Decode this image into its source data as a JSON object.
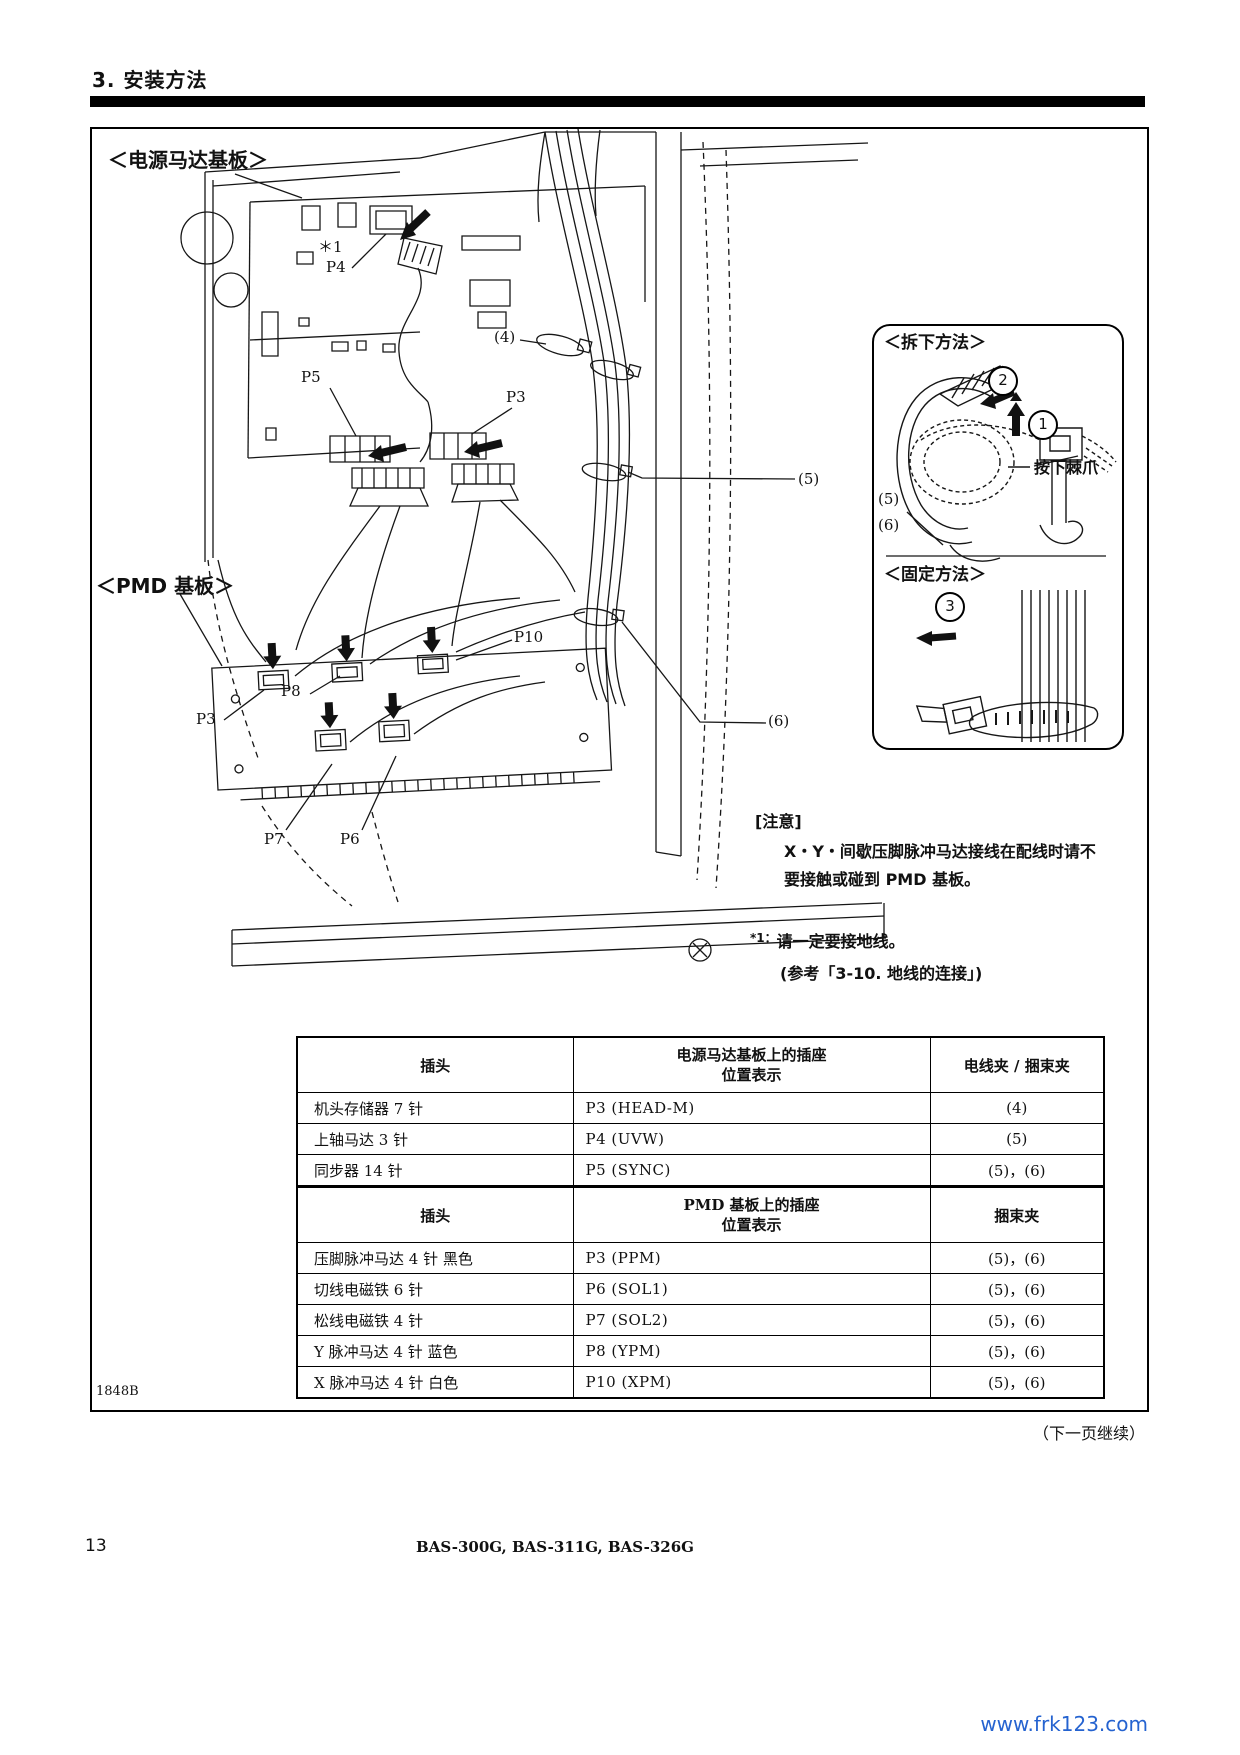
{
  "page": {
    "header": "3. 安装方法",
    "page_number": "13",
    "footer_models": "BAS-300G, BAS-311G, BAS-326G",
    "watermark": "www.frk123.com",
    "continued": "（下一页继续）",
    "figure_code": "1848B"
  },
  "diagram": {
    "board1": "＜电源马达基板＞",
    "board2": "＜PMD 基板＞",
    "labels": {
      "star1": "＊1",
      "p4": "P4",
      "c4": "(4)",
      "p5": "P5",
      "p3_top": "P3",
      "c5": "(5)",
      "p10": "P10",
      "c6": "(6)",
      "p8": "P8",
      "p3_bot": "P3",
      "p7": "P7",
      "p6": "P6"
    }
  },
  "inset": {
    "remove_title": "＜拆下方法＞",
    "fix_title": "＜固定方法＞",
    "step1": "1",
    "step2": "2",
    "step3": "3",
    "pawl": "按下棘爪",
    "c5": "(5)",
    "c6": "(6)"
  },
  "caution": {
    "title": "[注意]",
    "line1": "X・Y・间歇压脚脉冲马达接线在配线时请不",
    "line2": "要接触或碰到 PMD 基板。",
    "foot_mark": "*1：",
    "foot_text": "请一定要接地线。",
    "foot_ref": "(参考「3-10. 地线的连接」)"
  },
  "table": {
    "s1": {
      "h_plug": "插头",
      "h_pos1": "电源马达基板上的插座",
      "h_pos2": "位置表示",
      "h_clip": "电线夹 / 捆束夹",
      "rows": [
        [
          "机头存储器 7 针",
          "P3 (HEAD-M)",
          "(4)"
        ],
        [
          "上轴马达 3 针",
          "P4 (UVW)",
          "(5)"
        ],
        [
          "同步器 14 针",
          "P5 (SYNC)",
          "(5)，(6)"
        ]
      ]
    },
    "s2": {
      "h_plug": "插头",
      "h_pos1": "PMD 基板上的插座",
      "h_pos2": "位置表示",
      "h_clip": "捆束夹",
      "rows": [
        [
          "压脚脉冲马达 4 针 黑色",
          "P3 (PPM)",
          "(5)，(6)"
        ],
        [
          "切线电磁铁 6 针",
          "P6 (SOL1)",
          "(5)，(6)"
        ],
        [
          "松线电磁铁 4 针",
          "P7 (SOL2)",
          "(5)，(6)"
        ],
        [
          "Y 脉冲马达 4 针 蓝色",
          "P8 (YPM)",
          "(5)，(6)"
        ],
        [
          "X 脉冲马达 4 针 白色",
          "P10 (XPM)",
          "(5)，(6)"
        ]
      ]
    }
  }
}
